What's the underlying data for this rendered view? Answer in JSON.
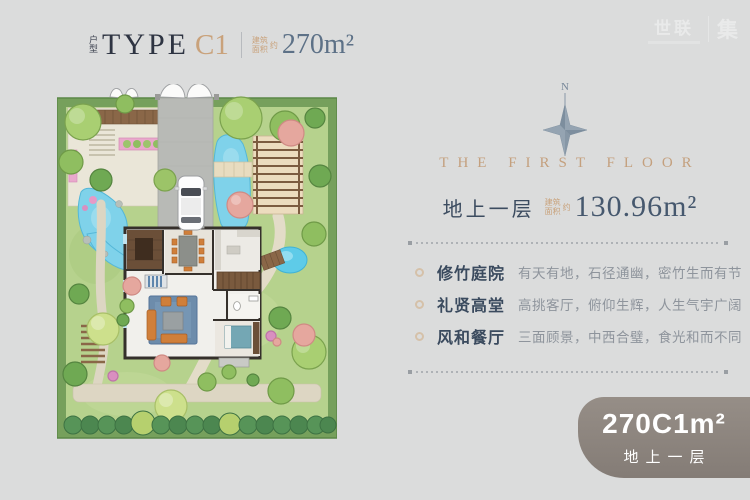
{
  "header": {
    "category_label": "户型",
    "type_word": "TYPE",
    "unit_code": "C1",
    "area_note_line1": "建筑",
    "area_note_line2": "面积",
    "area_note_suffix": "约",
    "area_value": "270m²"
  },
  "watermark": {
    "brand": "世联",
    "suffix": "集"
  },
  "floor_panel": {
    "compass_north": "N",
    "title": "THE FIRST FLOOR",
    "floor_name": "地上一层",
    "area_note_line1": "建筑",
    "area_note_line2": "面积",
    "area_note_suffix": "约",
    "area_value": "130.96m²",
    "features": [
      {
        "name": "修竹庭院",
        "desc": "有天有地，石径通幽，密竹生而有节"
      },
      {
        "name": "礼贤高堂",
        "desc": "高挑客厅，俯仰生辉，人生气宇广阔"
      },
      {
        "name": "风和餐厅",
        "desc": "三面顾景，中西合璧，食光和而不同"
      }
    ]
  },
  "badge": {
    "title": "270C1m²",
    "subtitle": "地上一层"
  },
  "colors": {
    "page_bg": "#dbdcdc",
    "accent_tan": "#c9a27c",
    "heading_navy": "#2f3442",
    "area_blue": "#5d7187",
    "badge_bg": "#8b837d",
    "lawn_green": "#b6d28d",
    "water_blue": "#7fd2ea"
  }
}
